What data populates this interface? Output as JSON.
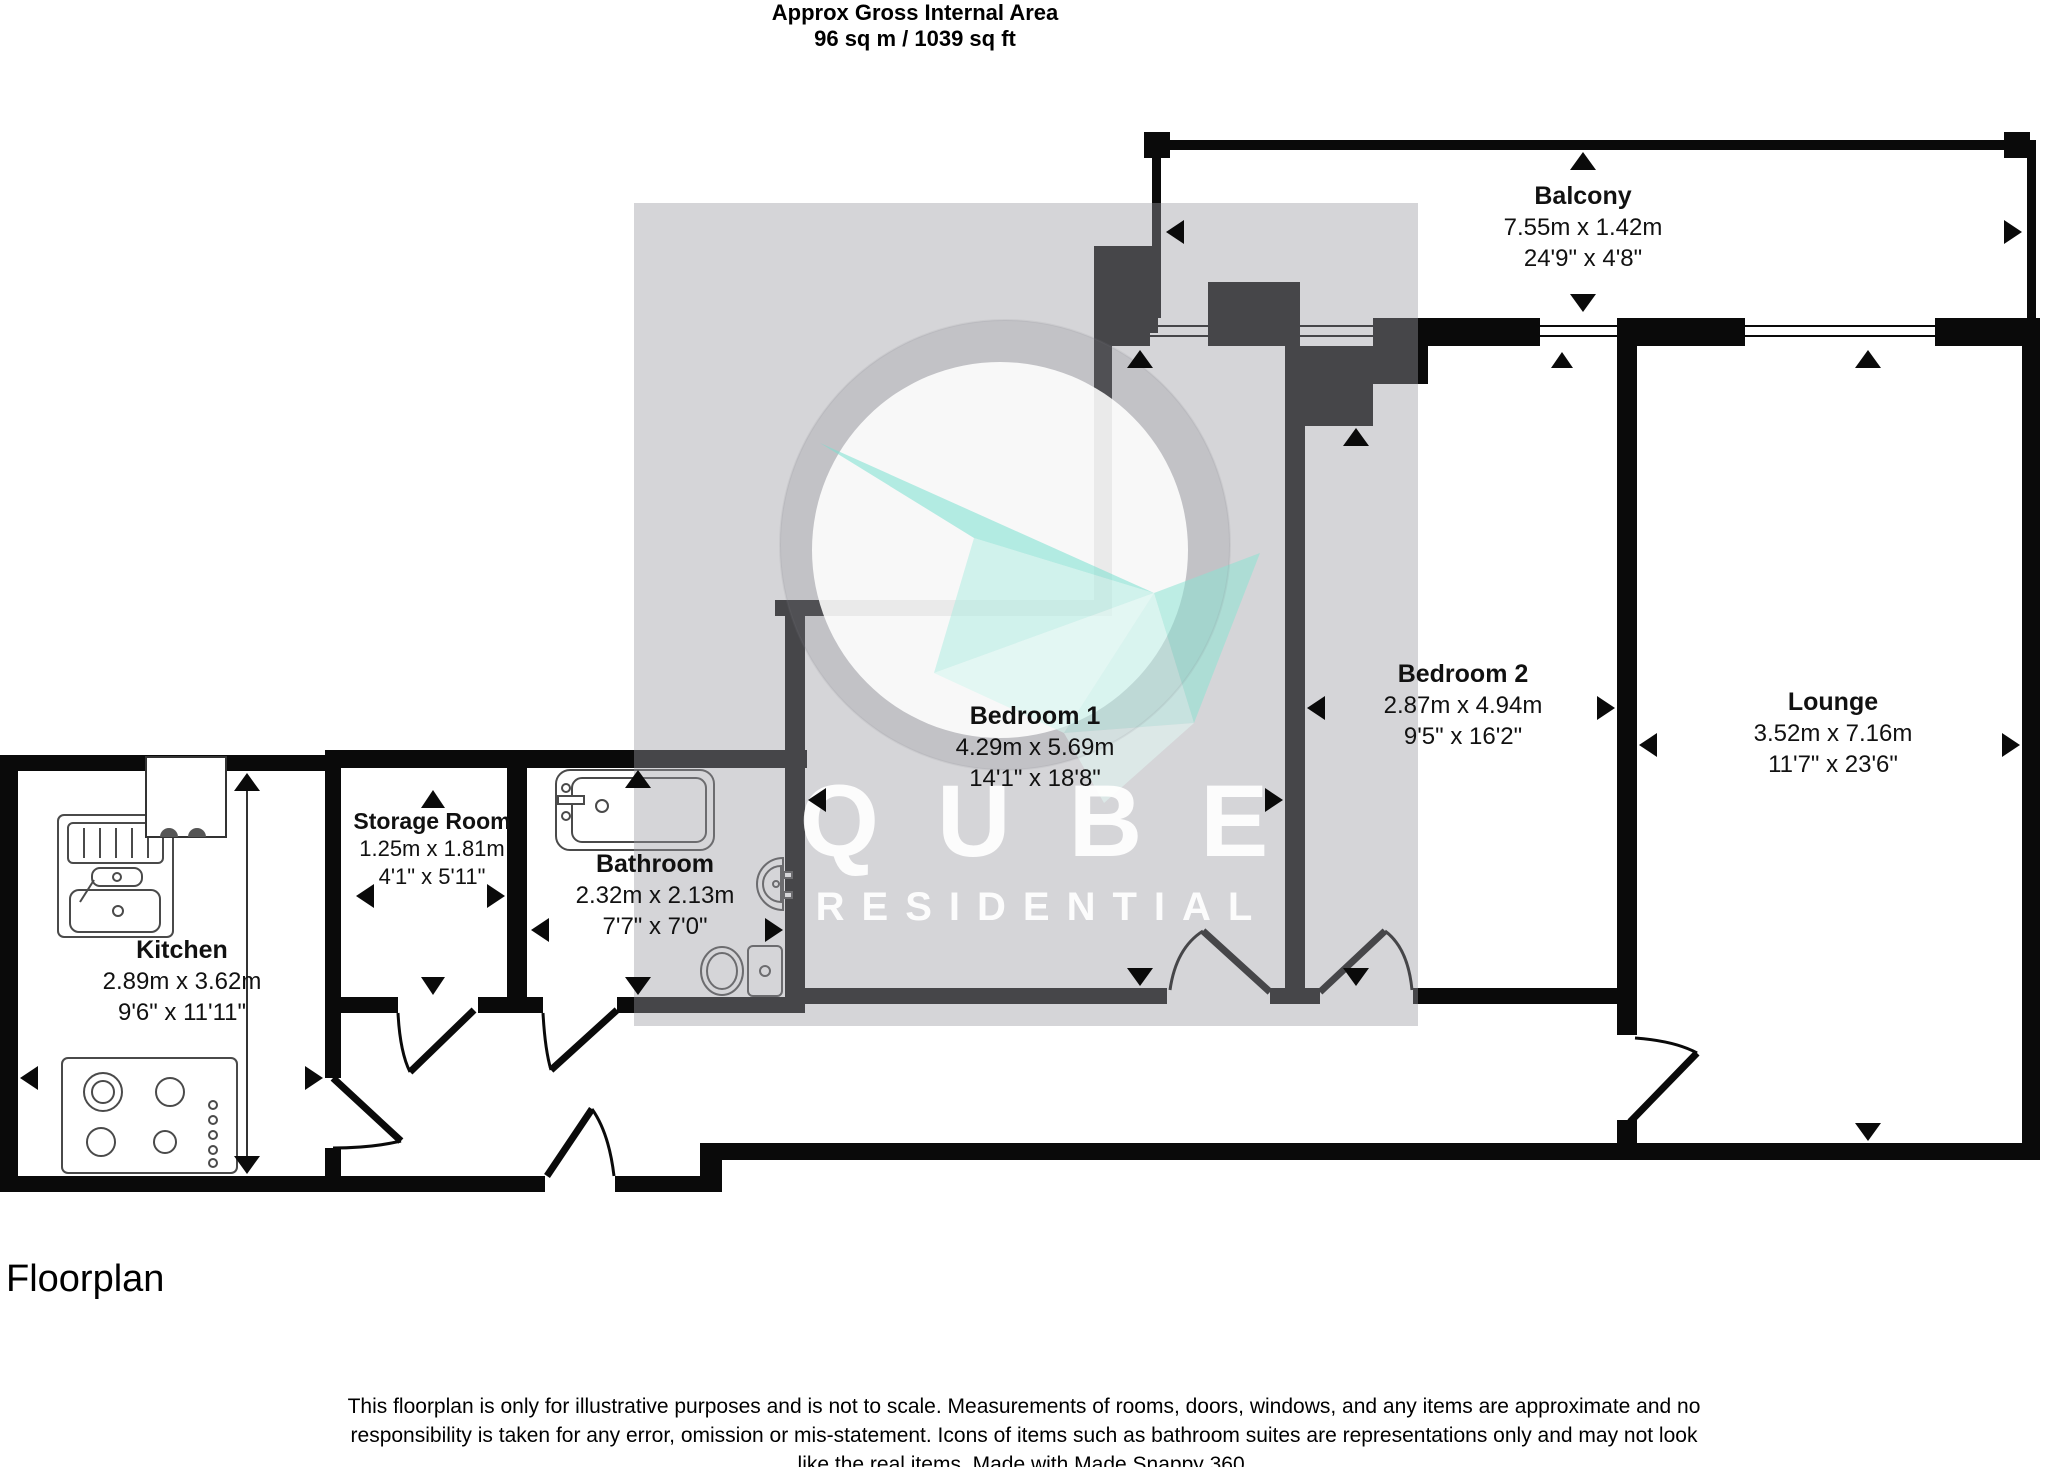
{
  "title": {
    "line1": "Approx Gross Internal Area",
    "line2": "96 sq m / 1039 sq ft"
  },
  "balcony": {
    "name": "Balcony",
    "metric": "7.55m x 1.42m",
    "imperial": "24'9\" x 4'8\""
  },
  "rooms": [
    {
      "name": "Bedroom 1",
      "metric": "4.29m x 5.69m",
      "imperial": "14'1\" x 18'8\""
    },
    {
      "name": "Bedroom 2",
      "metric": "2.87m x 4.94m",
      "imperial": "9'5\" x 16'2\""
    },
    {
      "name": "Lounge",
      "metric": "3.52m x 7.16m",
      "imperial": "11'7\" x 23'6\""
    },
    {
      "name": "Kitchen",
      "metric": "2.89m x 3.62m",
      "imperial": "9'6\" x 11'11\""
    },
    {
      "name": "Storage Room",
      "metric": "1.25m x 1.81m",
      "imperial": "4'1\" x 5'11\""
    },
    {
      "name": "Bathroom",
      "metric": "2.32m x 2.13m",
      "imperial": "7'7\" x 7'0\""
    }
  ],
  "watermark": {
    "brand": "QUBE",
    "subtitle": "RESIDENTIAL",
    "accent_teal": "#7fe0d0",
    "square_gray": "#d0d0d3"
  },
  "footer": {
    "section_label": "Floorplan",
    "disclaimer": "This floorplan is only for illustrative purposes and is not to scale. Measurements of rooms, doors, windows, and any items are approximate and no responsibility is taken for any error, omission or mis-statement. Icons of items such as bathroom suites are representations only and may not look like the real items. Made with Made Snappy 360."
  }
}
